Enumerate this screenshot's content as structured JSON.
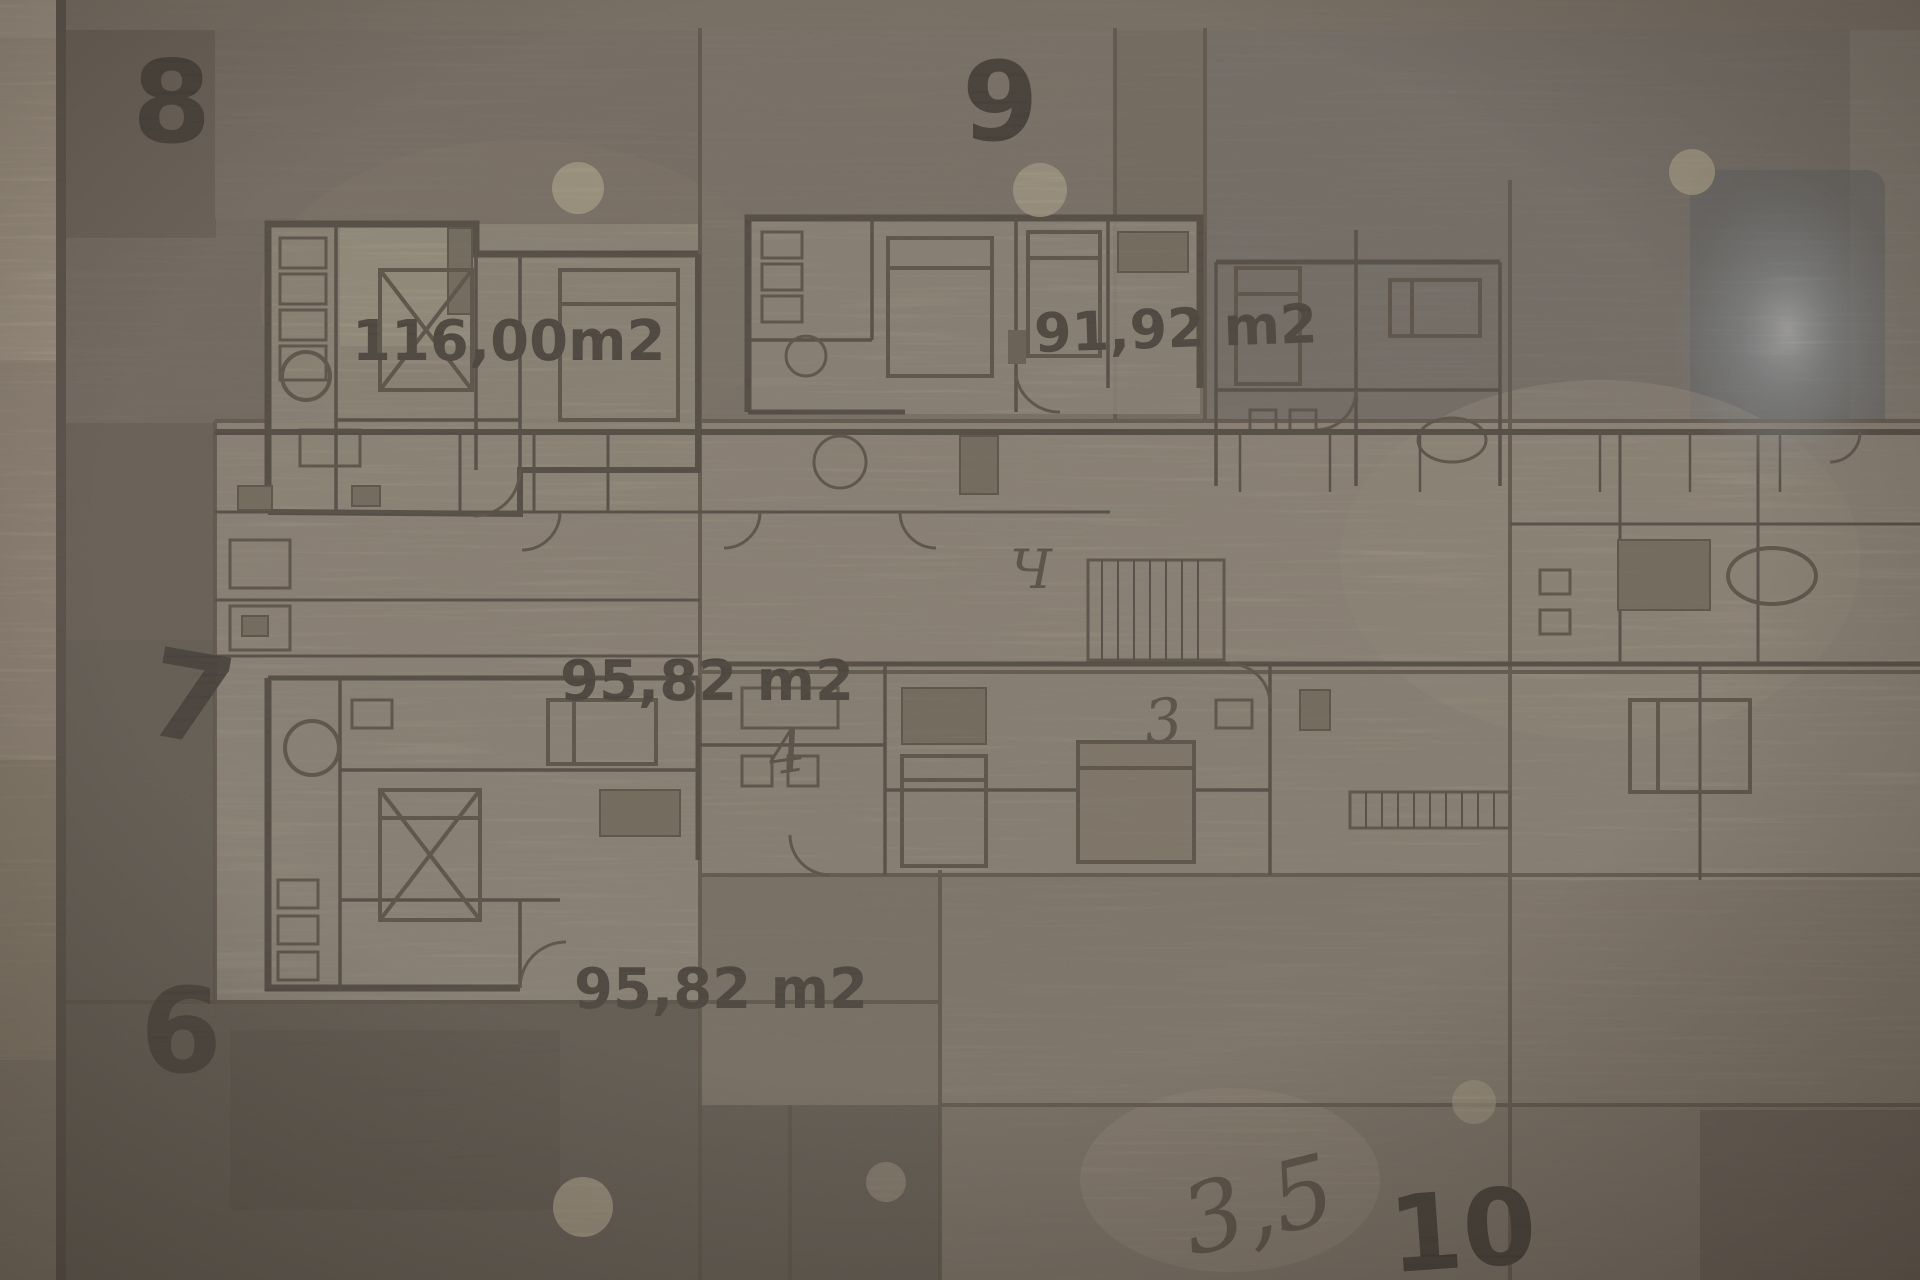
{
  "units": {
    "u8": {
      "number": "8",
      "area": "116,00m2"
    },
    "u9": {
      "number": "9",
      "area": "91,92 m2"
    },
    "u7": {
      "number": "7",
      "area": "95,82 m2"
    },
    "u6": {
      "number": "6",
      "area": "95,82 m2"
    },
    "u10": {
      "number": "10"
    }
  },
  "handwritten": {
    "slash_note": "3,5",
    "mark_4": "4",
    "mark_ch": "Ч",
    "mark_3": "3"
  },
  "colors": {
    "paper_light": "#b2a493",
    "paper_mid": "#9c8f81",
    "paper_dark": "#6e6358",
    "ink": "#4a4036",
    "numeral_ink": "#27211b",
    "glare": "#dfe7ee",
    "pin_dot": "#d9cbab"
  }
}
